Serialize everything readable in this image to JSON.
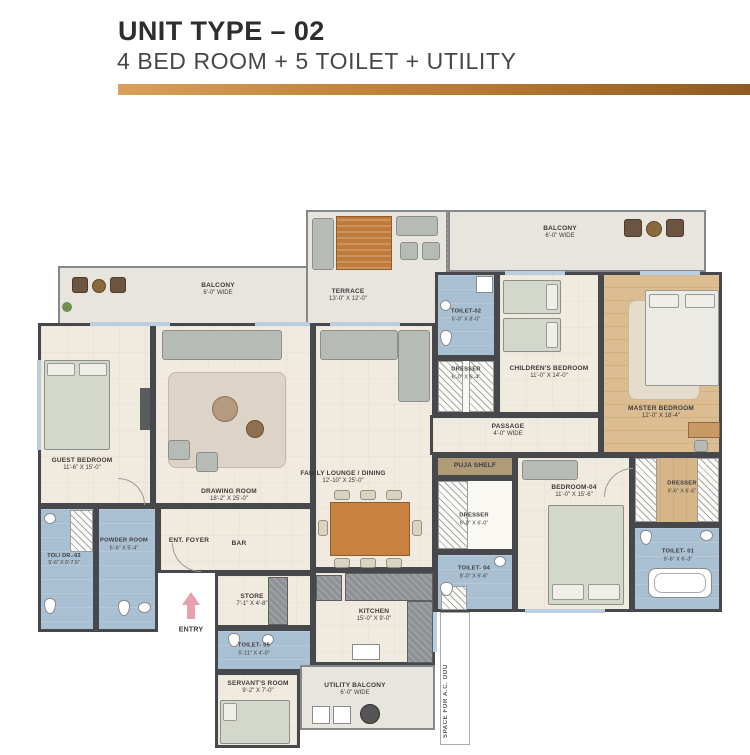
{
  "header": {
    "title": "UNIT TYPE – 02",
    "subtitle": "4 BED ROOM + 5 TOILET + UTILITY"
  },
  "rooms": {
    "balcony_left": {
      "name": "BALCONY",
      "dims": "6'-0\" WIDE"
    },
    "terrace": {
      "name": "TERRACE",
      "dims": "13'-0\" X 12'-0\""
    },
    "balcony_right": {
      "name": "BALCONY",
      "dims": "6'-0\" WIDE"
    },
    "toilet_02": {
      "name": "TOILET-02",
      "dims": "6'-0\" X 8'-0\""
    },
    "dresser_children": {
      "name": "DRESSER",
      "dims": "6'-0\" X 5'-4\""
    },
    "childrens_bedroom": {
      "name": "CHILDREN'S BEDROOM",
      "dims": "11'-0\" X 14'-0\""
    },
    "master_bedroom": {
      "name": "MASTER BEDROOM",
      "dims": "12'-0\" X 18'-4\""
    },
    "passage": {
      "name": "PASSAGE",
      "dims": "4'-0\" WIDE"
    },
    "puja_shelf": {
      "name": "PUJA SHELF",
      "dims": ""
    },
    "guest_bedroom": {
      "name": "GUEST BEDROOM",
      "dims": "11'-6\" X 15'-0\""
    },
    "drawing_room": {
      "name": "DRAWING ROOM",
      "dims": "18'-2\" X 25'-0\""
    },
    "family_lounge": {
      "name": "FAMILY LOUNGE / DINING",
      "dims": "12'-10\" X 25'-0\""
    },
    "toi_dr_03": {
      "name": "TOI./ DR.-03",
      "dims": "5'-6\" X 9'-7.5\""
    },
    "powder_room": {
      "name": "POWDER ROOM",
      "dims": "5'-6\" X 5'-4\""
    },
    "ent_foyer": {
      "name": "ENT. FOYER",
      "dims": ""
    },
    "bar": {
      "name": "BAR",
      "dims": ""
    },
    "store": {
      "name": "STORE",
      "dims": "7'-1\" X 4'-8\""
    },
    "toilet_05": {
      "name": "TOILET- 05",
      "dims": "5'-11\" X 4'-0\""
    },
    "servants_room": {
      "name": "SERVANT'S ROOM",
      "dims": "9'-2\" X 7'-0\""
    },
    "kitchen": {
      "name": "KITCHEN",
      "dims": "15'-0\" X 9'-0\""
    },
    "utility_balcony": {
      "name": "UTILITY BALCONY",
      "dims": "6'-0\" WIDE"
    },
    "dresser_bed04": {
      "name": "DRESSER",
      "dims": "6'-0\" X 6'-0\""
    },
    "toilet_04": {
      "name": "TOILET- 04",
      "dims": "8'-0\" X 6'-6\""
    },
    "bedroom_04": {
      "name": "BEDROOM-04",
      "dims": "11'-0\" X 15'-6\""
    },
    "dresser_master": {
      "name": "DRESSER",
      "dims": "9'-6\" X 6'-6\""
    },
    "toilet_01": {
      "name": "TOILET- 01",
      "dims": "9'-6\" X 6'-3\""
    }
  },
  "misc": {
    "entry": "ENTRY",
    "ac_space": "SPACE FOR A.C. ODU"
  },
  "colors": {
    "accent_gold": "#b97a33",
    "wall": "#47484c",
    "floor_beige": "#f1eadf",
    "toilet_blue": "#a9bfd2",
    "wood_floor": "#d8b88c",
    "balcony_gray": "#e8e5df",
    "entry_arrow_pink": "#e8a0ad"
  }
}
